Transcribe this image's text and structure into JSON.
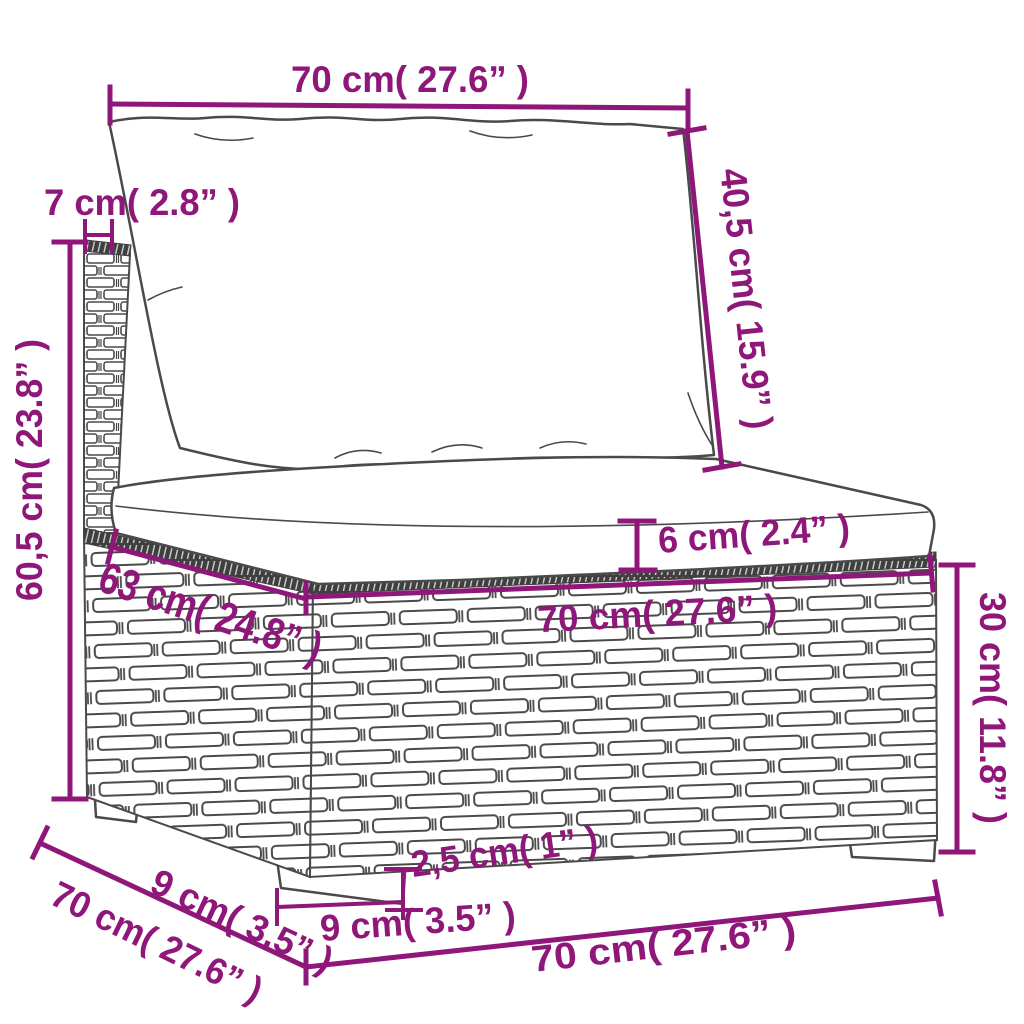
{
  "page": {
    "background_color": "#ffffff",
    "accent_color": "#8E1779",
    "drawing_outline_color": "#4a4a4a",
    "braid_color": "#3f3f3f"
  },
  "labels": {
    "back_cushion_width": "70 cm( 27.6” )",
    "back_cushion_height": "40,5 cm( 15.9” )",
    "back_panel_thickness": "7 cm( 2.8” )",
    "total_height": "60,5 cm( 23.8” )",
    "seat_cushion_thickness": "6 cm( 2.4” )",
    "seat_width": "70 cm( 27.6” )",
    "seat_depth": "63 cm( 24.8” )",
    "base_height": "30 cm( 11.8” )",
    "leg_height": "2,5 cm( 1” )",
    "front_leg_width": "9 cm( 3.5” )",
    "side_leg_depth": "9 cm( 3.5” )",
    "total_depth": "70 cm( 27.6” )",
    "total_width": "70 cm( 27.6” )"
  }
}
